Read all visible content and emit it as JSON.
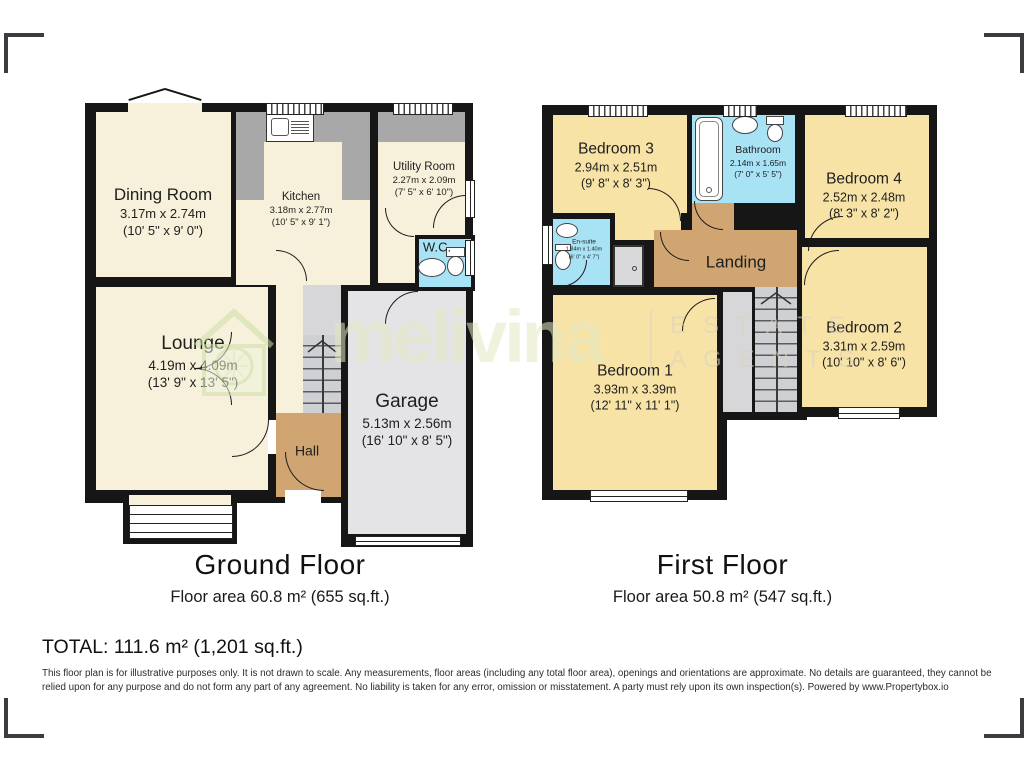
{
  "watermark": {
    "brand": "melivina",
    "estate": "ESTATE",
    "agents": "AGENTS"
  },
  "ground": {
    "title": "Ground Floor",
    "area": "Floor area 60.8 m² (655 sq.ft.)",
    "rooms": {
      "dining": {
        "name": "Dining Room",
        "metric": "3.17m x 2.74m",
        "imperial": "(10' 5\" x 9' 0\")"
      },
      "kitchen": {
        "name": "Kitchen",
        "metric": "3.18m x 2.77m",
        "imperial": "(10' 5\" x 9' 1\")"
      },
      "utility": {
        "name": "Utility Room",
        "metric": "2.27m x 2.09m",
        "imperial": "(7' 5\" x 6' 10\")"
      },
      "wc": {
        "name": "W.C."
      },
      "lounge": {
        "name": "Lounge",
        "metric": "4.19m x 4.09m",
        "imperial": "(13' 9\" x 13' 5\")"
      },
      "hall": {
        "name": "Hall"
      },
      "garage": {
        "name": "Garage",
        "metric": "5.13m x 2.56m",
        "imperial": "(16' 10\" x 8' 5\")"
      }
    }
  },
  "first": {
    "title": "First Floor",
    "area": "Floor area 50.8 m² (547 sq.ft.)",
    "rooms": {
      "bedroom3": {
        "name": "Bedroom 3",
        "metric": "2.94m x 2.51m",
        "imperial": "(9' 8\" x 8' 3\")"
      },
      "bathroom": {
        "name": "Bathroom",
        "metric": "2.14m x 1.65m",
        "imperial": "(7' 0\" x 5' 5\")"
      },
      "bedroom4": {
        "name": "Bedroom 4",
        "metric": "2.52m x 2.48m",
        "imperial": "(8' 3\" x 8' 2\")"
      },
      "ensuite": {
        "name": "En-suite",
        "metric": "1.84m x 1.40m",
        "imperial": "(6' 0\" x 4' 7\")"
      },
      "landing": {
        "name": "Landing"
      },
      "bedroom1": {
        "name": "Bedroom 1",
        "metric": "3.93m x 3.39m",
        "imperial": "(12' 11\" x 11' 1\")"
      },
      "bedroom2": {
        "name": "Bedroom 2",
        "metric": "3.31m x 2.59m",
        "imperial": "(10' 10\" x 8' 6\")"
      }
    }
  },
  "total": "TOTAL: 111.6 m² (1,201 sq.ft.)",
  "disclaimer": "This floor plan is for illustrative purposes only. It is not drawn to scale. Any measurements, floor areas (including any total floor area), openings and orientations are approximate. No details are guaranteed, they cannot be relied upon for any purpose and do not form any part of any agreement. No liability is taken for any error, omission or misstatement. A party must rely upon its own inspection(s). Powered by www.Propertybox.io",
  "colors": {
    "wall": "#161616",
    "room_cream": "#f7f1dc",
    "bedroom_yellow": "#f8e3a6",
    "hall_tan": "#d0a571",
    "wet_blue": "#a8e2f5",
    "garage_gray": "#e4e4e6",
    "counter_gray": "#a8a8a8",
    "watermark_yellow": "#e4e8c2"
  },
  "icons": {
    "toilet-icon": "ellipse+tank css shape",
    "sink-icon": "ellipse css shape",
    "bathtub-icon": "rounded rect css shape",
    "shower-icon": "gray square css shape",
    "kitchen-sink-icon": "square+grill css shape",
    "stairs-up-arrow-icon": "svg chevron",
    "house-logo-icon": "svg house outline",
    "door-arc-icon": "quarter-circle css arc",
    "corner-bracket-icon": "L-shaped css border"
  }
}
